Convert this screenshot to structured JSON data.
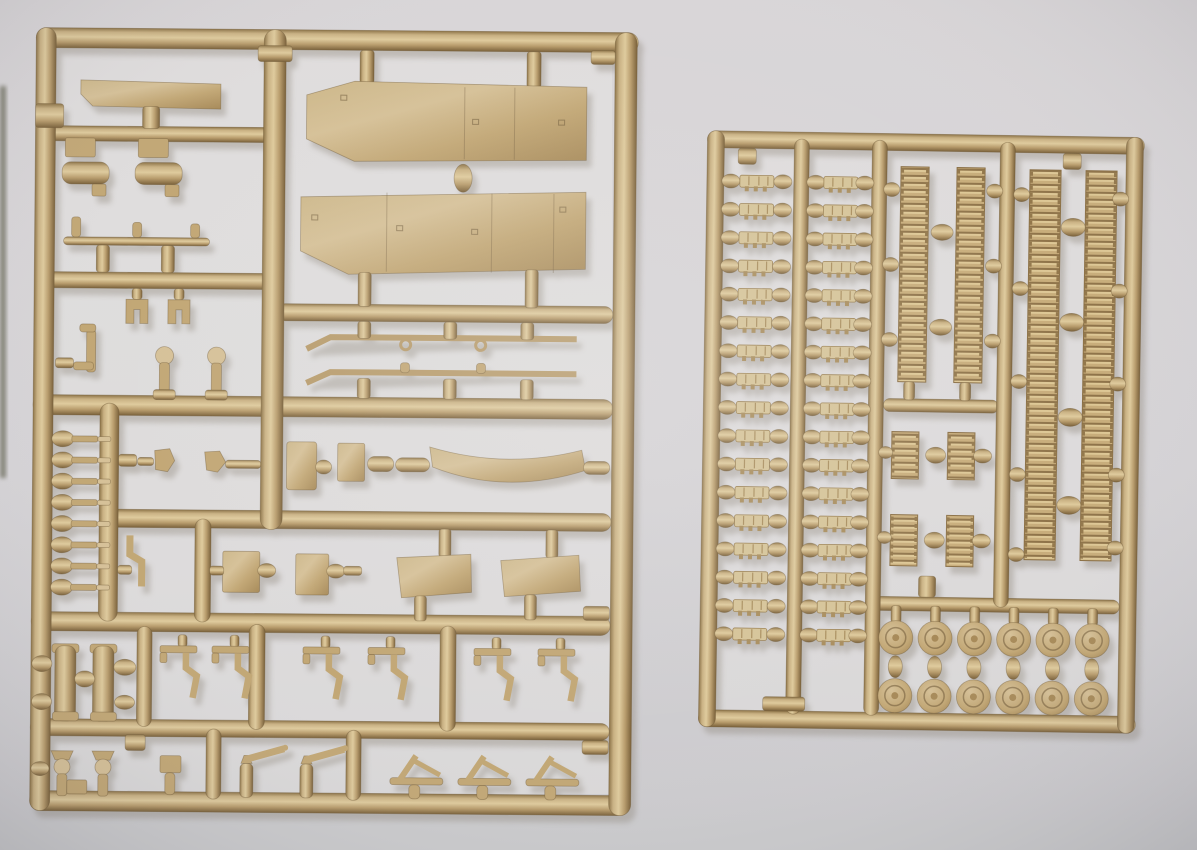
{
  "scene": {
    "description": "Photograph of two tan injection-molded plastic model kit sprues (part trees) lying on light gray paper; left sprue holds tank hull fittings and fenders, right sprue holds track links, track sections and road wheels",
    "text_content": "none - the photograph contains no readable text"
  },
  "colors": {
    "paper_outer": "#d9d6d8",
    "paper_mid": "#d5d3d6",
    "paper_bottom": "#cbcacd",
    "paper_inner": "#e5e3e2",
    "photo_left_edge": "#6e6e5e",
    "plastic_dark": "#8d7448",
    "plastic_lighter": "#c9b183",
    "plastic_light": "#dfcb9d",
    "plastic_mid": "#b89c6c",
    "plastic_darker": "#7a613a",
    "plastic_outline": "#6f5836",
    "panel_sheen": "#cdb88b",
    "panel_light": "#d6c198",
    "panel_mid": "#c2a775",
    "panel_dark": "#a78a59",
    "link_body": "#d6c498",
    "link_teeth": "#a98e5e",
    "track_base": "#c8ad7b",
    "track_ridge_dark": "#8f744a",
    "track_ridge_light": "#ddc795",
    "shadow": "#8b8377",
    "vignette_edge": "rgba(40,40,55,0.14)"
  },
  "left_sprue": {
    "description": "Large rectangular sprue with hull parts: two long fenders, flat panels, rods, clamps, hooks and small fittings",
    "counts": {
      "large_fender_panels": 2,
      "top_flat_panel": 1,
      "cylinder_brackets": 2,
      "axle_rod_with_pins": 1,
      "u_clamps": 2,
      "periscope_part": 1,
      "ball_head_pins": 2,
      "side_pins": 8,
      "small_pentagon_parts": 2,
      "upper_small_plates": 2,
      "curved_fender": 1,
      "thin_rods": 2,
      "lower_square_plates": 2,
      "trapezoid_panels": 2,
      "crank_tool": 1,
      "tow_cylinders": 2,
      "bent_hooks": 6,
      "valve_parts": 2,
      "small_block_part": 1,
      "spray_nozzle_parts": 2,
      "mud_flap_parts": 3
    }
  },
  "right_sprue": {
    "description": "Smaller rectangular sprue densely filled with individual track links, lengths of assembled track and paired road wheels",
    "single_track_links": {
      "columns": 2,
      "per_column": 17
    },
    "track_sections": {
      "tall_center_pair": 1,
      "short_center_pairs": 2,
      "full_length_right_pair": 1
    },
    "road_wheels": {
      "columns": 6,
      "per_column": 2
    }
  }
}
